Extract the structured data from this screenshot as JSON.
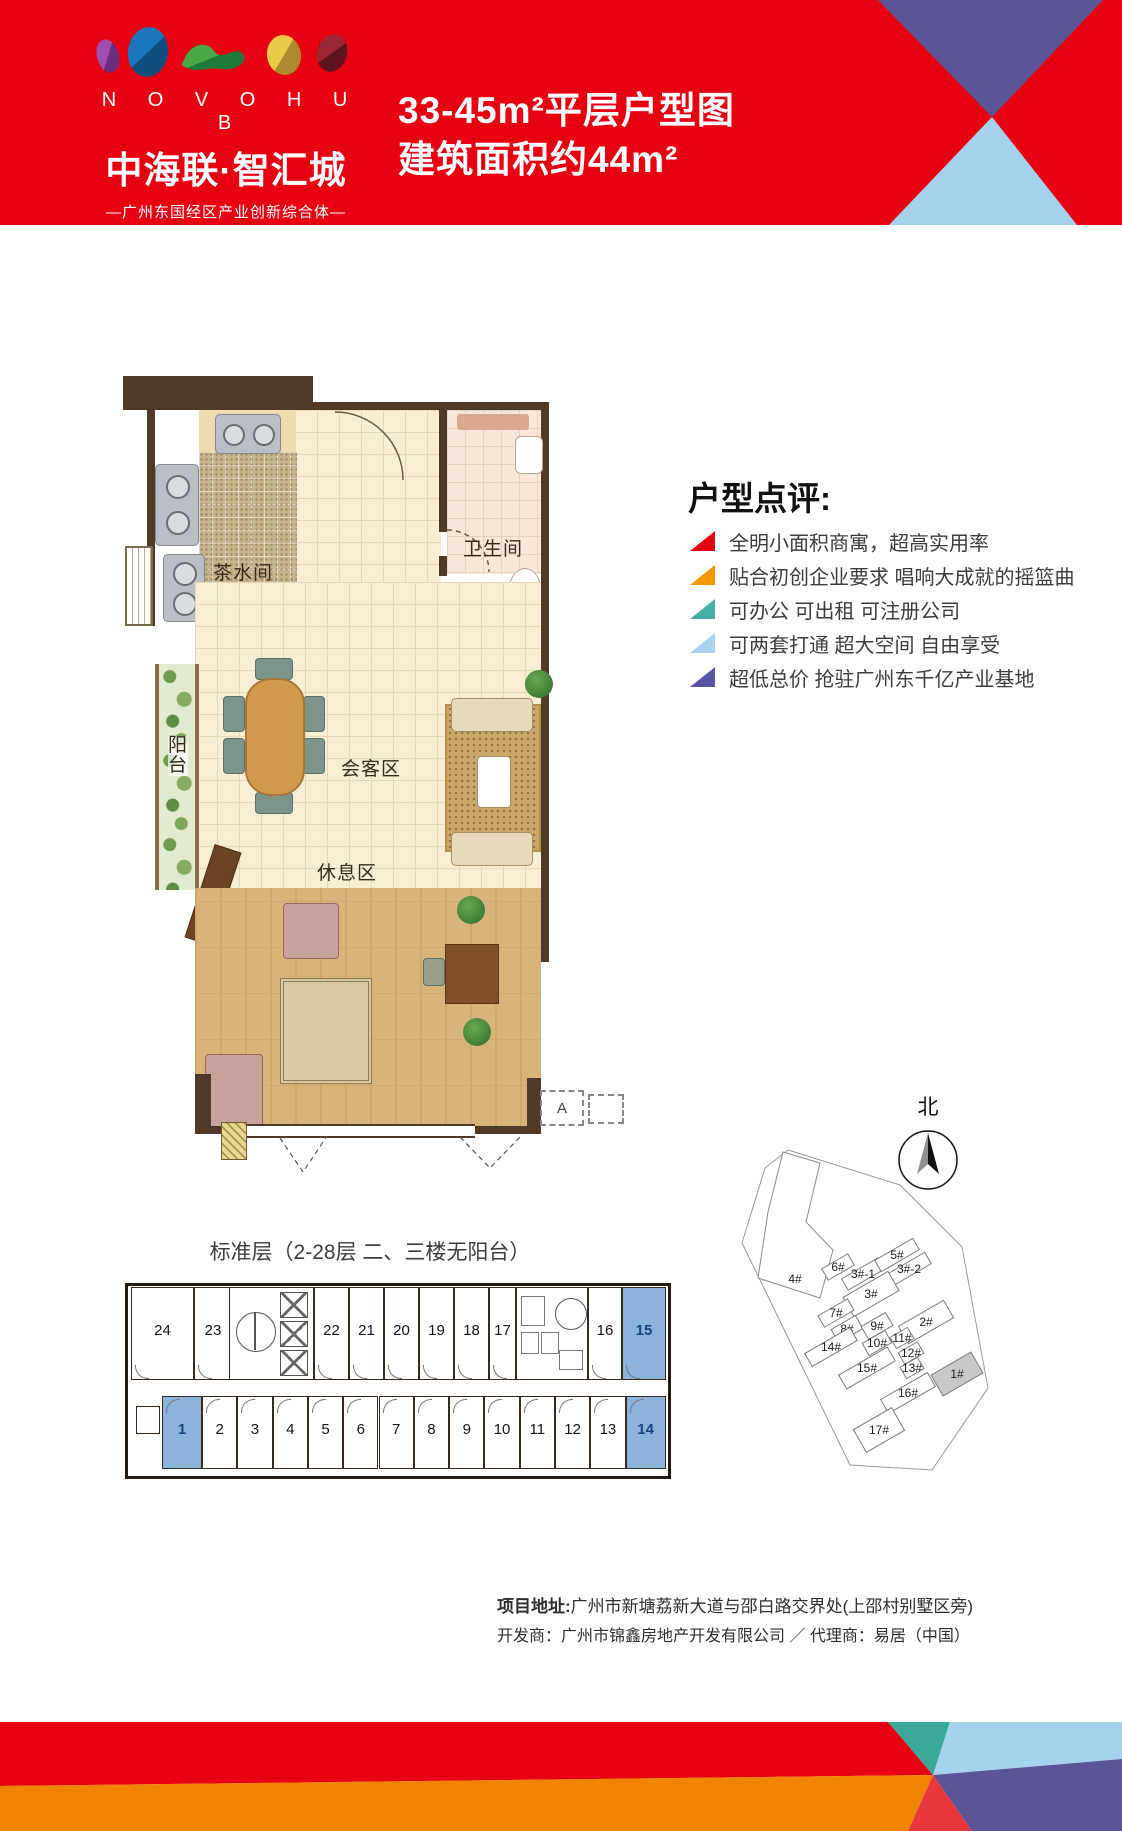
{
  "header": {
    "logo_letters": "N O V O H U B",
    "brand": "中海联·智汇城",
    "tagline": "—广州东国经区产业创新综合体—",
    "title_line1": "33-45m²平层户型图",
    "title_line2": "建筑面积约44m²"
  },
  "review": {
    "heading": "户型点评:",
    "bullets": [
      {
        "text": "全明小面积商寓，超高实用率",
        "color": "#e60012"
      },
      {
        "text": "贴合初创企业要求 唱响大成就的摇篮曲",
        "color": "#f39800"
      },
      {
        "text": "可办公 可出租 可注册公司",
        "color": "#45b0a2"
      },
      {
        "text": "可两套打通 超大空间 自由享受",
        "color": "#a8d2ee"
      },
      {
        "text": "超低总价 抢驻广州东千亿产业基地",
        "color": "#5a55a0"
      }
    ]
  },
  "floorplan": {
    "rooms": {
      "tea": "茶水间",
      "bath": "卫生间",
      "meeting": "会客区",
      "balcony": "阳台",
      "rest": "休息区"
    },
    "annotation": "A"
  },
  "standard_floor": {
    "caption": "标准层（2-28层 二、三楼无阳台）",
    "top_row": [
      "24",
      "23",
      "22",
      "21",
      "20",
      "19",
      "18",
      "17",
      "16",
      "15"
    ],
    "bottom_row": [
      "1",
      "2",
      "3",
      "4",
      "5",
      "6",
      "7",
      "8",
      "9",
      "10",
      "11",
      "12",
      "13",
      "14"
    ],
    "highlighted_units": [
      "1",
      "14",
      "15"
    ],
    "highlight_color": "#8cb3d9"
  },
  "sitemap": {
    "north_label": "北",
    "buildings": [
      {
        "label": "4#",
        "x": 170,
        "y": 194
      },
      {
        "label": "6#",
        "x": 213,
        "y": 182,
        "w": 30,
        "h": 13
      },
      {
        "label": "3#-1",
        "x": 238,
        "y": 189,
        "w": 42,
        "h": 13
      },
      {
        "label": "5#",
        "x": 272,
        "y": 170,
        "w": 44,
        "h": 13
      },
      {
        "label": "3#-2",
        "x": 284,
        "y": 184,
        "w": 44,
        "h": 13
      },
      {
        "label": "3#",
        "x": 246,
        "y": 209,
        "w": 52,
        "h": 22
      },
      {
        "label": "7#",
        "x": 211,
        "y": 228,
        "w": 34,
        "h": 13
      },
      {
        "label": "8#",
        "x": 222,
        "y": 244,
        "w": 28,
        "h": 15
      },
      {
        "label": "9#",
        "x": 252,
        "y": 241,
        "w": 28,
        "h": 15
      },
      {
        "label": "2#",
        "x": 301,
        "y": 237,
        "w": 52,
        "h": 20
      },
      {
        "label": "10#",
        "x": 252,
        "y": 258,
        "w": 26,
        "h": 14
      },
      {
        "label": "11#",
        "x": 277,
        "y": 253,
        "w": 20,
        "h": 13
      },
      {
        "label": "12#",
        "x": 286,
        "y": 268,
        "w": 22,
        "h": 13
      },
      {
        "label": "14#",
        "x": 206,
        "y": 262,
        "w": 52,
        "h": 15
      },
      {
        "label": "13#",
        "x": 287,
        "y": 283,
        "w": 20,
        "h": 13
      },
      {
        "label": "15#",
        "x": 242,
        "y": 283,
        "w": 56,
        "h": 16
      },
      {
        "label": "16#",
        "x": 283,
        "y": 308,
        "w": 54,
        "h": 16
      },
      {
        "label": "1#",
        "x": 332,
        "y": 289,
        "w": 46,
        "h": 24,
        "fill": "#c9c9c9"
      },
      {
        "label": "17#",
        "x": 254,
        "y": 345,
        "w": 44,
        "h": 26
      }
    ]
  },
  "footer": {
    "address_label": "项目地址:",
    "address": "广州市新塘荔新大道与邵白路交界处(上邵村别墅区旁)",
    "line2": "开发商：广州市锦鑫房地产开发有限公司 ／ 代理商：易居（中国）"
  },
  "colors": {
    "brand_red": "#e60012",
    "orange": "#f08300",
    "teal": "#3aa99a",
    "light_blue": "#a5d3ee",
    "slate_blue": "#5a5696",
    "highlight_blue": "#8cb3d9"
  }
}
